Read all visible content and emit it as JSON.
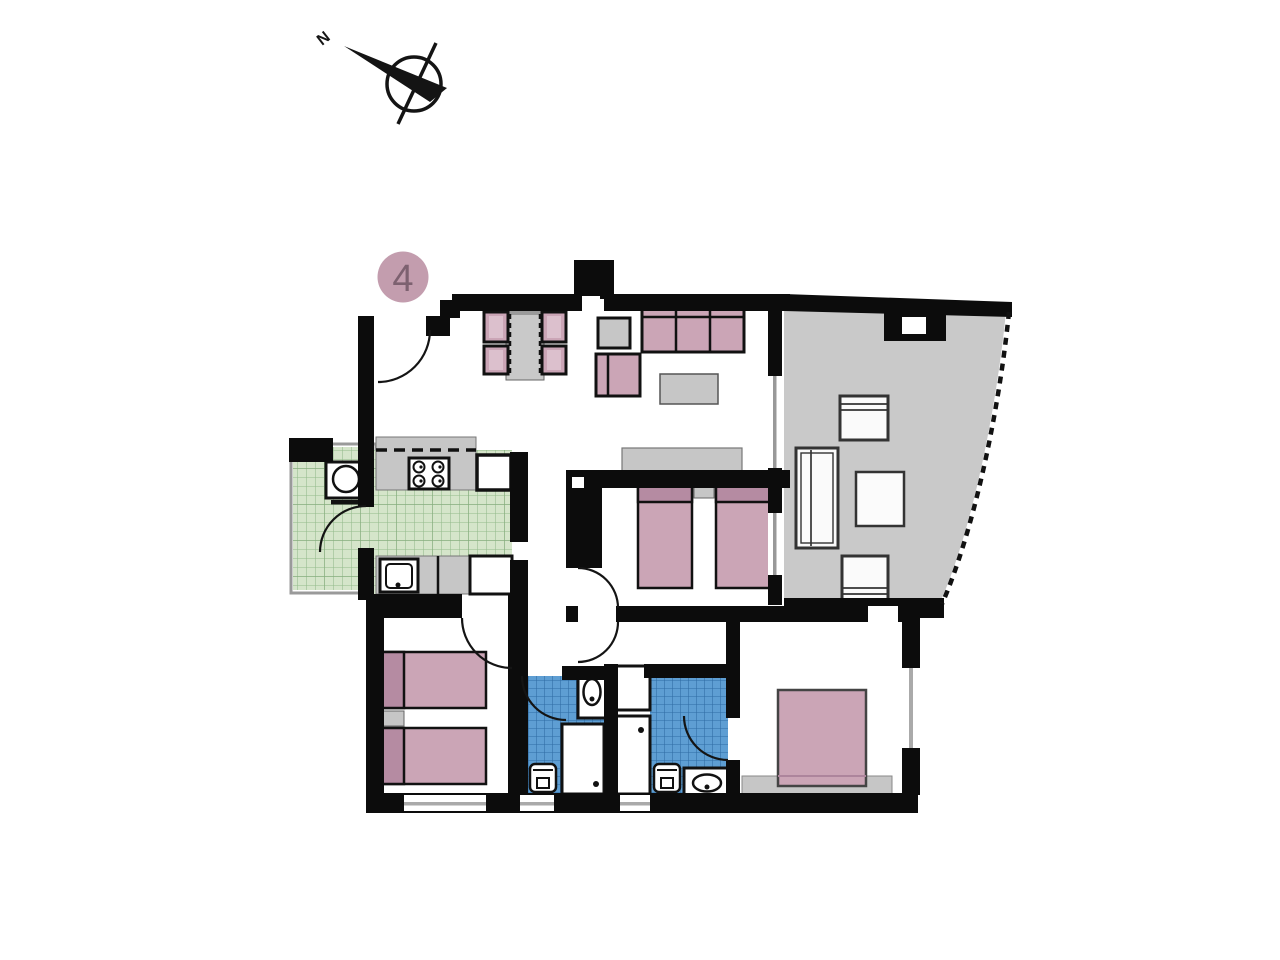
{
  "meta": {
    "title": "Apartment floor plan"
  },
  "badge": {
    "value": "4",
    "bg": "#c39dae",
    "fg": "#7d6170"
  },
  "compass": {
    "label": "N"
  },
  "palette": {
    "wall": "#0c0c0c",
    "furniture_pink": "#cba5b6",
    "pink_dark": "#b58ba2",
    "furniture_gray": "#c6c6c6",
    "terrace_floor": "#c9c9c9",
    "green_tile": "#d5e5ca",
    "green_line": "#94ba8b",
    "blue_tile": "#5e9ed3",
    "blue_line": "#2f6ca4",
    "fixture_white": "#ffffff"
  },
  "rooms": [
    {
      "name": "living-dining",
      "floor": "white",
      "furniture": [
        "dining-table",
        "dining-chair x4",
        "side-table",
        "sofa-3-seat",
        "armchair",
        "coffee-table",
        "sideboard"
      ]
    },
    {
      "name": "kitchen",
      "floor": "green-tile",
      "furniture": [
        "counter-with-stove-4-burners",
        "wall-cabinet-dashed",
        "fridge",
        "sink-counter",
        "base-cabinet"
      ]
    },
    {
      "name": "utility-balcony",
      "floor": "green-tile",
      "furniture": [
        "washing-machine"
      ]
    },
    {
      "name": "terrace",
      "floor": "gray",
      "edge": "curved-dashed-glass-railing",
      "furniture": [
        "terrace-chair x2",
        "sun-lounger",
        "terrace-table"
      ]
    },
    {
      "name": "bedroom-2",
      "floor": "white",
      "furniture": [
        "single-bed x2",
        "nightstand"
      ]
    },
    {
      "name": "bedroom-1",
      "floor": "white",
      "furniture": [
        "single-bed x2",
        "nightstand"
      ]
    },
    {
      "name": "master-bedroom",
      "floor": "white",
      "furniture": [
        "double-bed",
        "dresser"
      ],
      "window": "right-wall"
    },
    {
      "name": "bathroom-1",
      "floor": "blue-tile",
      "furniture": [
        "washbasin",
        "shower",
        "toilet"
      ]
    },
    {
      "name": "bathroom-2",
      "floor": "blue-tile",
      "furniture": [
        "washbasin",
        "shower",
        "toilet",
        "cupboard"
      ]
    }
  ],
  "doors": [
    "entrance-top-left",
    "balcony-kitchen",
    "bedroom-1",
    "bedroom-2",
    "hallway",
    "bathroom-1",
    "bathroom-2",
    "master-bedroom"
  ],
  "windows": [
    "bottom-wall x3",
    "master-right-wall",
    "terrace-sliding-door x2"
  ]
}
